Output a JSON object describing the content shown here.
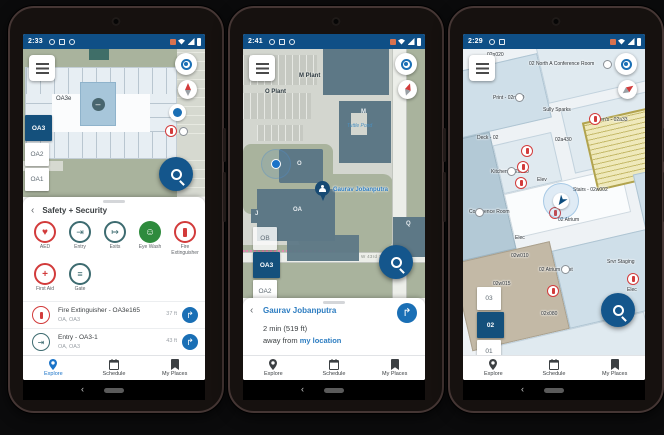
{
  "colors": {
    "statusbar_bg": "#0f4f86",
    "accent_blue": "#1a6fb5",
    "selected_floor_bg": "#14507c",
    "link_blue": "#2d7dc1",
    "safety_red": "#d23b3b",
    "teal": "#3d6b70",
    "eyewash_green": "#2e8b3d",
    "map_green": "#a9b39d",
    "building_slate": "#5d7886",
    "stairs_yellow": "#efe9bb"
  },
  "icons": {
    "menu": "hamburger",
    "locate": "gps-target",
    "compass": "compass-needle",
    "search": "magnifier",
    "directions_glyph": "↱",
    "back_glyph": "‹",
    "no_entry_glyph": "–",
    "aed_glyph": "♥",
    "entry_glyph": "⇥",
    "exits_glyph": "↦",
    "eyewash_glyph": "☺",
    "firstaid_glyph": "+",
    "gate_glyph": "≡"
  },
  "phones": [
    {
      "status": {
        "time": "2:33"
      },
      "map": {
        "room_label": "OA3e",
        "floors": [
          {
            "label": "OA3",
            "selected": true
          },
          {
            "label": "OA2",
            "selected": false
          },
          {
            "label": "OA1",
            "selected": false
          }
        ]
      },
      "sheet": {
        "title": "Safety + Security",
        "categories": [
          {
            "label": "AED"
          },
          {
            "label": "Entry"
          },
          {
            "label": "Exits"
          },
          {
            "label": "Eye Wash"
          },
          {
            "label": "Fire Extinguisher"
          },
          {
            "label": "First Aid"
          },
          {
            "label": "Gate"
          }
        ],
        "items": [
          {
            "title": "Fire Extinguisher - OA3e165",
            "subtitle": "OA, OA3",
            "distance": "37 ft"
          },
          {
            "title": "Entry - OA3-1",
            "subtitle": "OA, OA3",
            "distance": "43 ft"
          }
        ]
      },
      "nav": {
        "items": [
          "Explore",
          "Schedule",
          "My Places"
        ],
        "active": "Explore"
      }
    },
    {
      "status": {
        "time": "2:41"
      },
      "map": {
        "labels": {
          "o_plant": "O Plant",
          "m_plant": "M Plant",
          "m": "M",
          "pond": "Tuttle Pond",
          "o": "O",
          "oa": "OA",
          "q": "Q",
          "j": "J",
          "street": "W 43rd St"
        },
        "pin_label": "Gaurav Jobanputra",
        "floors": [
          {
            "label": "OB",
            "selected": false
          },
          {
            "label": "OA3",
            "selected": true
          },
          {
            "label": "OA2",
            "selected": false
          }
        ]
      },
      "sheet": {
        "title": "Gaurav Jobanputra",
        "eta": "2 min (519 ft)",
        "away_prefix": "away from ",
        "away_link": "my location"
      },
      "nav": {
        "items": [
          "Explore",
          "Schedule",
          "My Places"
        ],
        "active": "Explore"
      }
    },
    {
      "status": {
        "time": "2:29"
      },
      "map": {
        "labels": [
          "02n020",
          "02 North A Conference Room",
          "Print - 02n010",
          "Sully Sparks",
          "Men's - 02a33",
          "Deck - 02",
          "02a430",
          "Elec",
          "Kitchen - 02a510",
          "Elev",
          "Stairs - 02w002",
          "02 Atrium",
          "Conference Room",
          "Elec",
          "02w010",
          "02 Atrium West",
          "02w015",
          "Srvr Staging",
          "02x080",
          "AC Unit",
          "Elec"
        ],
        "floors": [
          {
            "label": "03",
            "selected": false
          },
          {
            "label": "02",
            "selected": true
          },
          {
            "label": "01",
            "selected": false
          }
        ]
      },
      "nav": {
        "items": [
          "Explore",
          "Schedule",
          "My Places"
        ],
        "active": "Explore"
      }
    }
  ]
}
